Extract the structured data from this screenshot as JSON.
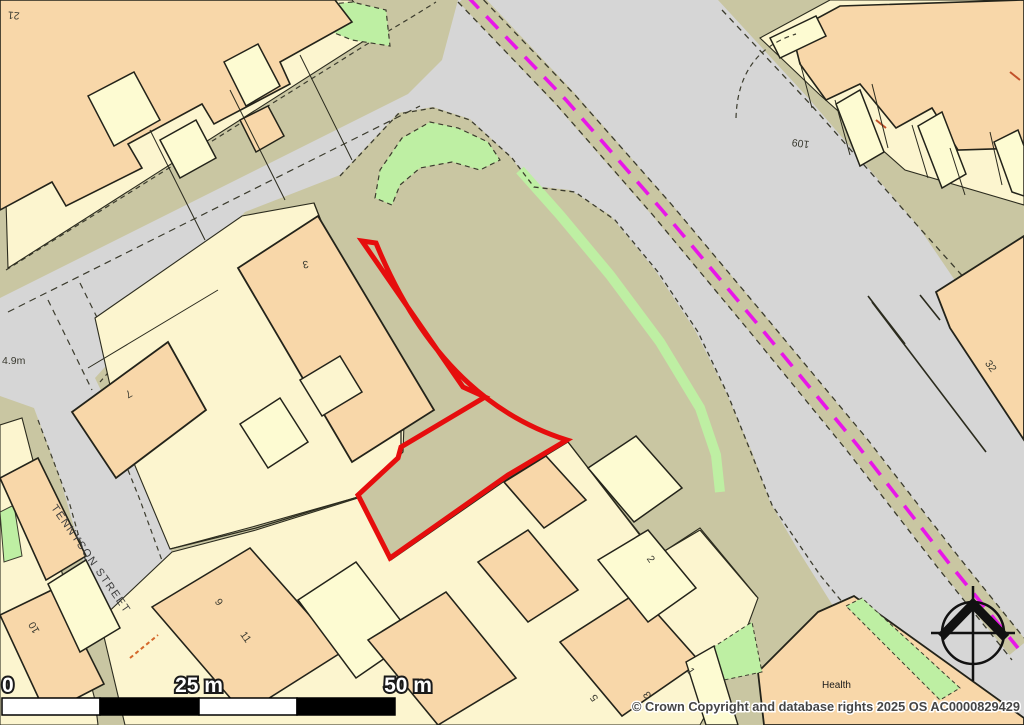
{
  "map": {
    "type": "ordnance-survey-extract",
    "street_name": "TENNYSON STREET",
    "depth_label": "4.9m",
    "poi_label": "Health",
    "house_numbers": {
      "top_left_block": "21",
      "top_right_block": "109",
      "plot_32": "32",
      "house_7": "7",
      "house_3_centre": "3",
      "terrace_9": "9",
      "terrace_11": "11",
      "terrace_10": "10",
      "terrace_5": "5",
      "terrace_3": "3",
      "terrace_1": "1",
      "terrace_2": "2"
    },
    "selection": {
      "description": "red site boundary outline",
      "color": "#e60d0d"
    },
    "admin_boundary_color": "#e816e8",
    "colors": {
      "road": "#d6d6d6",
      "urban_olive": "#c9c6a2",
      "plot_yellow": "#fcf5cf",
      "building_peach": "#f8d7a9",
      "building_cream": "#fdfbd2",
      "green_space": "#beefa3",
      "line": "#2b2b1e"
    }
  },
  "scale_bar": {
    "label_0": "0",
    "label_25": "25 m",
    "label_50": "50 m"
  },
  "attribution": "© Crown Copyright and database rights 2025 OS AC0000829429"
}
